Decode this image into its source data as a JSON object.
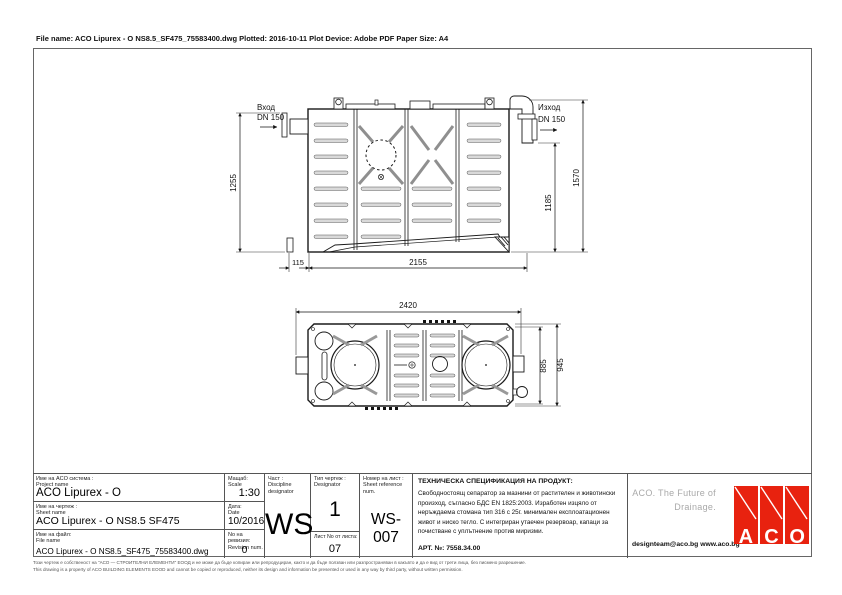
{
  "header": {
    "file_info": "File name: ACO Lipurex - O NS8.5_SF475_75583400.dwg   Plotted: 2016-10-11   Plot Device: Adobe PDF   Paper Size: A4"
  },
  "drawing": {
    "side_view": {
      "inlet_label": "Вход",
      "inlet_dn": "DN 150",
      "outlet_label": "Изход",
      "outlet_dn": "DN 150",
      "dim_inlet_height": "1255",
      "dim_foot_offset": "115",
      "dim_body_length": "2155",
      "dim_outlet_height": "1185",
      "dim_total_height": "1570"
    },
    "plan_view": {
      "dim_total_length": "2420",
      "dim_body_width": "885",
      "dim_total_width": "945"
    }
  },
  "title_block": {
    "project": {
      "label_bg": "Име на ACO система :",
      "label_en": "Project name",
      "value": "ACO Lipurex - O"
    },
    "sheet": {
      "label_bg": "Име на чертеж :",
      "label_en": "Sheet name",
      "value": "ACO Lipurex - O  NS8.5 SF475"
    },
    "file": {
      "label_bg": "Име на файл:",
      "label_en": "File name",
      "value": "ACO Lipurex - O NS8.5_SF475_75583400.dwg"
    },
    "scale": {
      "label_bg": "Мащаб:",
      "label_en": "Scale",
      "value": "1:30"
    },
    "date": {
      "label_bg": "Дата:",
      "label_en": "Date",
      "value": "10/2016"
    },
    "revision": {
      "label_bg": "No на ревизия:",
      "label_en": "Revision num.",
      "value": "0"
    },
    "discipline": {
      "label_bg": "Част :",
      "label_en": "Discipline designator",
      "value": "WS"
    },
    "type": {
      "label_bg": "Тип чертеж :",
      "label_en": "Designator",
      "value": "1"
    },
    "sheet_no": {
      "label_bg": "Лист No от листа:",
      "value": "07"
    },
    "sheet_ref": {
      "label_bg": "Номер на лист :",
      "label_en": "Sheet reference num.",
      "value": "WS-007"
    },
    "spec": {
      "title": "ТЕХНИЧЕСКА СПЕЦИФИКАЦИЯ НА ПРОДУКТ:",
      "body": "Свободностоящ сепаратор за мазнини от растителен и животински произход, съгласно БДС EN 1825:2003. Изработен изцяло от неръждаема стомана тип 316 с 25г. минимален експлоатационен живот и ниско тегло. С интегриран утаечен резервоар, капаци за почистване с уплътнение против миризми.",
      "art_no": "АРТ. №: 7558.34.00"
    },
    "branding": {
      "slogan_line1": "ACO. The Future of",
      "slogan_line2": "Drainage.",
      "contacts": "designteam@aco.bg  www.aco.bg",
      "logo_letters": {
        "0": "A",
        "1": "C",
        "2": "O"
      },
      "logo_color": "#e8220f"
    }
  },
  "footer": {
    "line_bg": "Този чертеж е собственост на \"АСО — СТРОИТЕЛНИ ЕЛЕМЕНТИ\" ЕООД и не може да бъде копиран или репродуциран, както и да бъде ползван или разпространяван в какъвто и да е вид от трети лица, без писмено разрешение.",
    "line_en": "This drawing is a property of ACO BUILDING ELEMENTS EOOD and cannot be copied or reproduced, neither its design and information be presented or used in any way by third party, without written permission."
  }
}
